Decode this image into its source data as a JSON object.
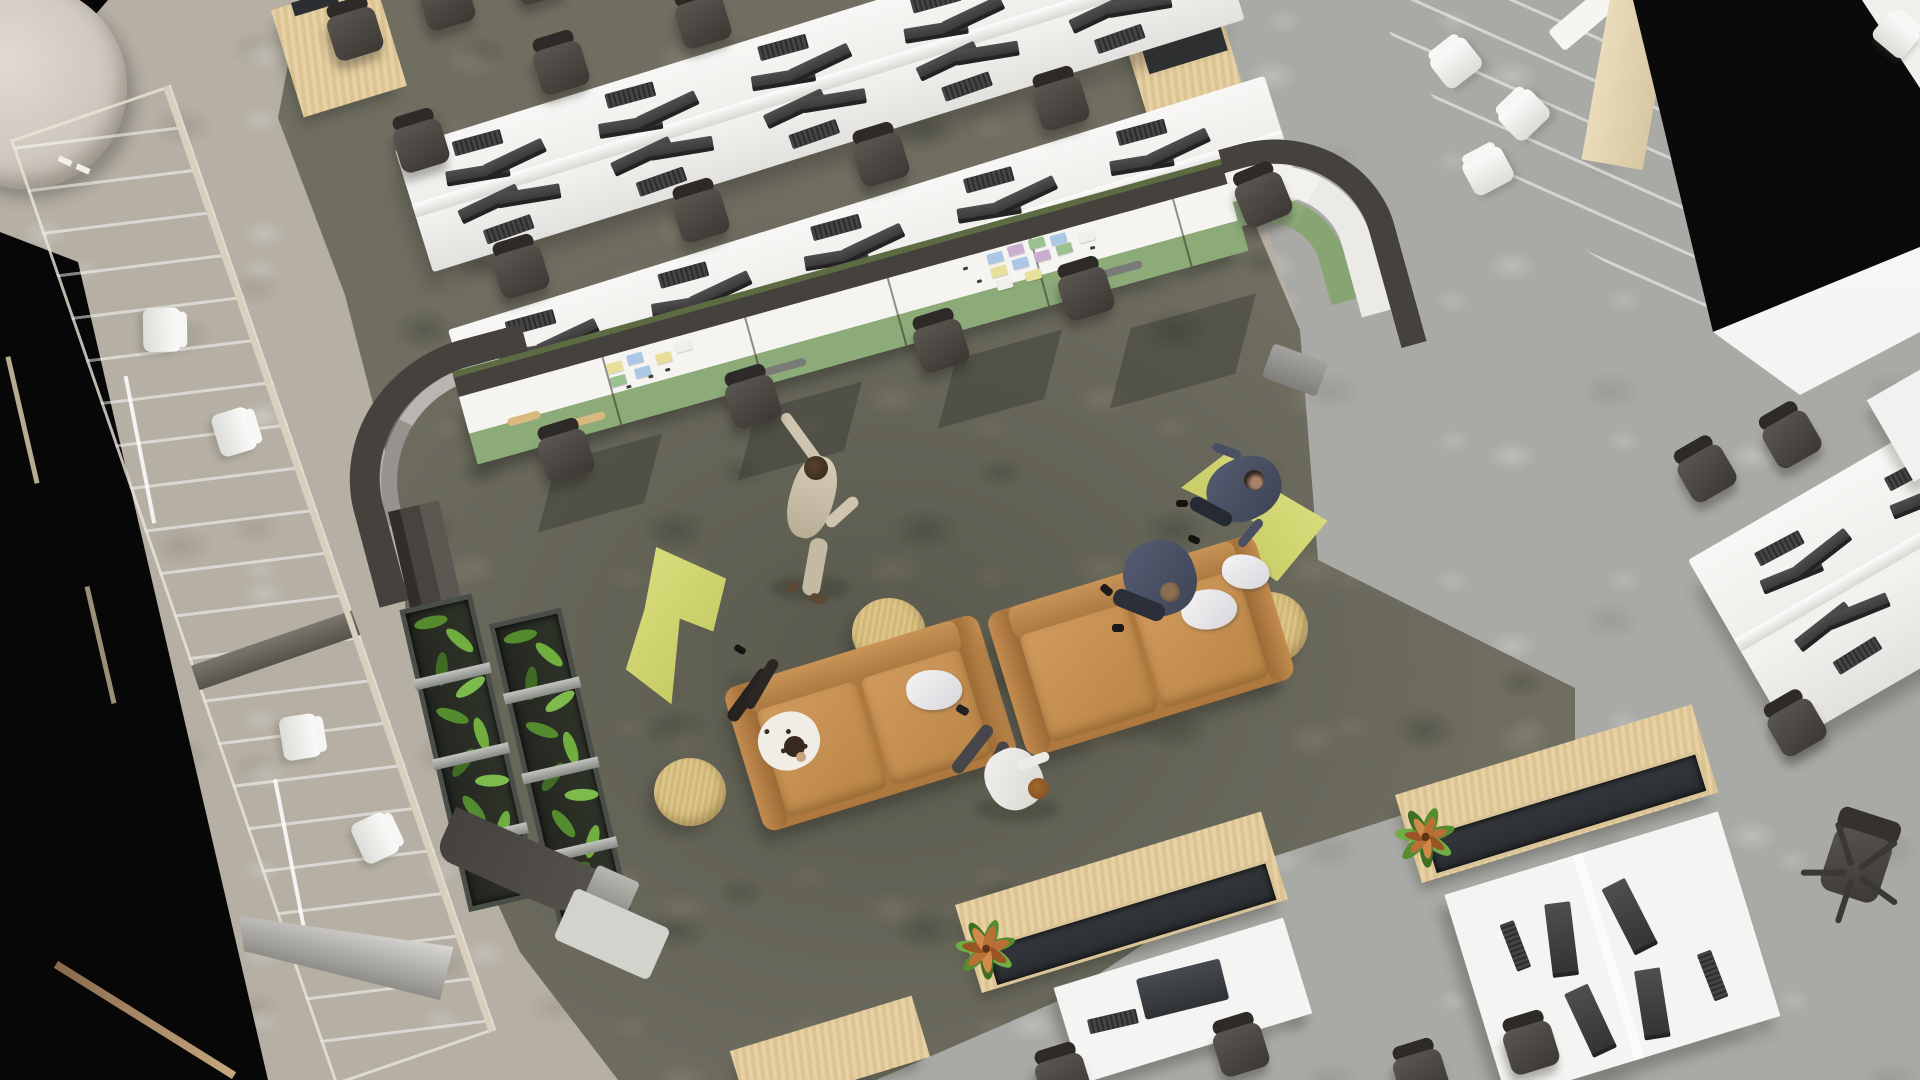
{
  "scene": {
    "type": "3D architectural rendering",
    "view": "top-down aerial",
    "environment": "open-plan office with central collaboration lounge",
    "people_count": 5
  },
  "labels": {
    "stage": "Aerial rendering of an open-plan office",
    "floor": "Mottled carpet flooring in warm grey, cool grey and olive zones",
    "collab_area": "Collaboration lounge enclosed by curved charcoal partition",
    "whiteboard_wall": "Whiteboard wall with green lower band and sticky notes",
    "planter_wall": "Partition-mounted planter troughs with greenery",
    "desk_benches": "Open-plan white bench desks with dual monitors and task chairs",
    "meeting_room_left": "Glass-walled meeting room with white chairs (left)",
    "meeting_room_top_right": "Glass-walled meeting room with white chairs (top right)",
    "desk_pods": "Desk pods with wooden planter credenzas",
    "right_desk_cluster": "Angled white desk cluster (right side)",
    "lounge_furniture": "Camel sofas, lime lounge chairs and round tan side tables",
    "reception_table": "Round beige table at top-left",
    "black_wall": "Dark wall void along the left edge",
    "black_ceiling": "Dark ceiling plane at top right"
  },
  "palette": {
    "floor_warm_grey": "#b5afa4",
    "floor_cool_grey": "#a9a9a6",
    "carpet_olive": "#6f6e61",
    "partition_charcoal": "#45423e",
    "partition_green_cap": "#5c6b42",
    "whiteboard_white": "#f5f4f1",
    "whiteboard_green": "#8cab79",
    "desk_white": "#f3f2ef",
    "chair_dark": "#3b3834",
    "sofa_camel": "#c38c4f",
    "lounge_lime": "#ccd16b",
    "table_tan": "#d8c084",
    "wood_light": "#e0caa0",
    "plant_green": "#5f9339",
    "plant_rust": "#b96f35",
    "pillow_white": "#ececef",
    "glass_tint": "#ced3c9",
    "black": "#070707"
  },
  "collab": {
    "whiteboard_panels": 6,
    "sticky_note_colors": [
      "#aac7e6",
      "#9cc191",
      "#e8e09a",
      "#c9aed0",
      "#f0efec"
    ],
    "marker_tray_color": "#7a7a78",
    "wood_tray_color": "#d8b87c"
  },
  "people": [
    {
      "id": "person-standing-whiteboard",
      "pose": "standing, arm raised to whiteboard",
      "clothing": "beige suit"
    },
    {
      "id": "person-sofa-left",
      "pose": "seated, legs extended",
      "clothing": "white patterned top"
    },
    {
      "id": "person-sofa-right",
      "pose": "seated cross-legged",
      "clothing": "navy"
    },
    {
      "id": "person-lounge-chair",
      "pose": "seated cross-legged on lime chair",
      "clothing": "navy"
    },
    {
      "id": "person-walking",
      "pose": "walking near sofas",
      "clothing": "white shirt, grey trousers"
    }
  ],
  "furniture_counts": {
    "desk_bench_rows": 2,
    "task_chairs": 22,
    "sofas": 2,
    "lime_lounge_chairs": 2,
    "round_side_tables": 3,
    "planter_credenzas": 3,
    "glass_meeting_rooms": 2
  }
}
